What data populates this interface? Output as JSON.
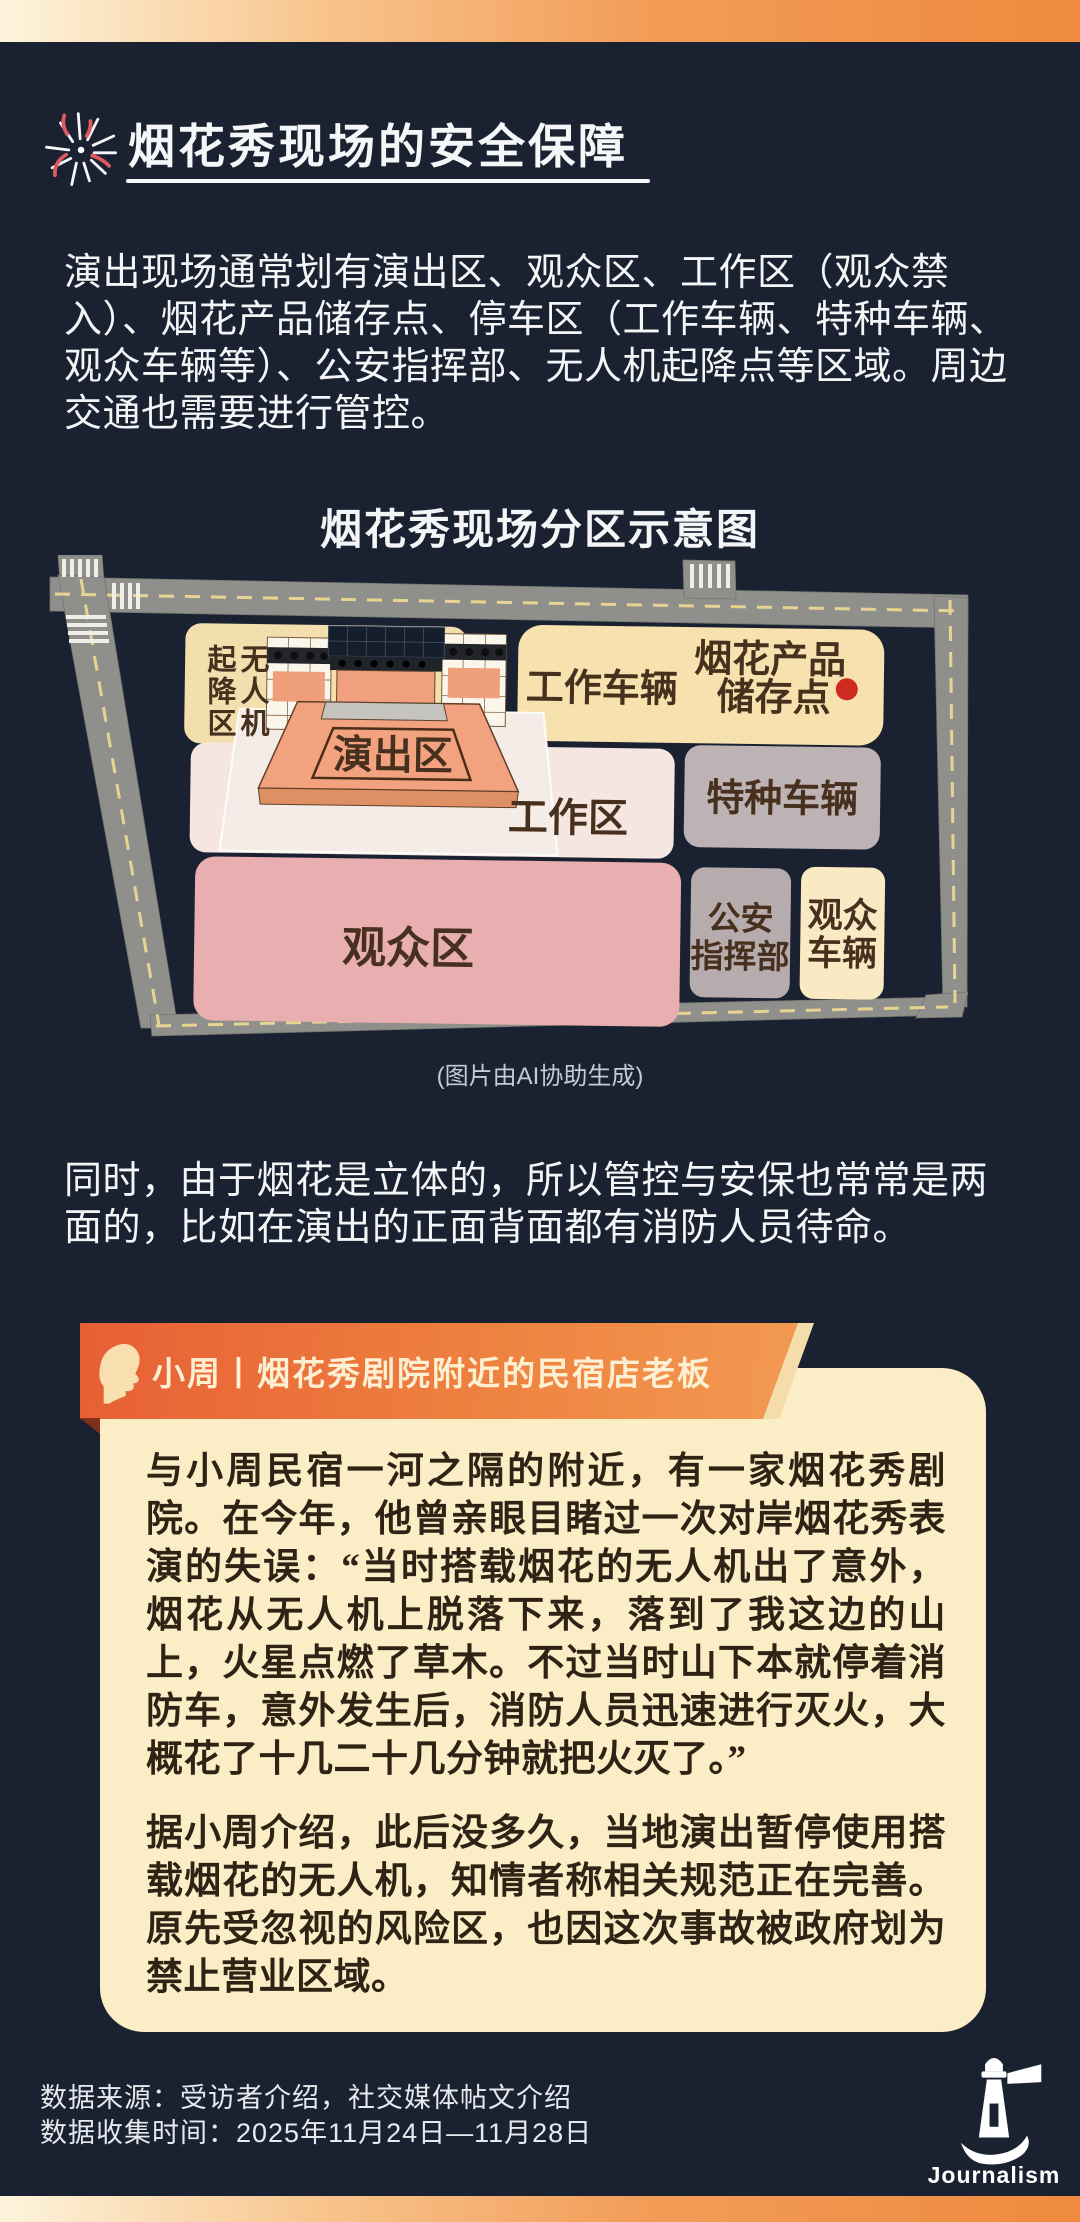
{
  "header": {
    "title": "烟花秀现场的安全保障"
  },
  "intro": "演出现场通常划有演出区、观众区、工作区（观众禁入）、烟花产品储存点、停车区（工作车辆、特种车辆、观众车辆等）、公安指挥部、无人机起降点等区域。周边交通也需要进行管控。",
  "diagram": {
    "title": "烟花秀现场分区示意图",
    "caption": "(图片由AI协助生成)",
    "zones": {
      "drone": "无人机起降区",
      "stage": "演出区",
      "work_vehicles": "工作车辆",
      "storage_l1": "烟花产品",
      "storage_l2": "储存点",
      "work_area": "工作区",
      "special_vehicles": "特种车辆",
      "audience_area": "观众区",
      "police_l1": "公安",
      "police_l2": "指挥部",
      "audience_vehicles_l1": "观众",
      "audience_vehicles_l2": "车辆"
    }
  },
  "body_paragraph": "同时，由于烟花是立体的，所以管控与安保也常常是两面的，比如在演出的正面背面都有消防人员待命。",
  "quote_card": {
    "header": "小周丨烟花秀剧院附近的民宿店老板",
    "paragraph1": "与小周民宿一河之隔的附近，有一家烟花秀剧院。在今年，他曾亲眼目睹过一次对岸烟花秀表演的失误：“当时搭载烟花的无人机出了意外，烟花从无人机上脱落下来，落到了我这边的山上，火星点燃了草木。不过当时山下本就停着消防车，意外发生后，消防人员迅速进行灭火，大概花了十几二十几分钟就把火灭了。”",
    "paragraph2": "据小周介绍，此后没多久，当地演出暂停使用搭载烟花的无人机，知情者称相关规范正在完善。原先受忽视的风险区，也因这次事故被政府划为禁止营业区域。"
  },
  "footer": {
    "source": "数据来源：受访者介绍，社交媒体帖文介绍",
    "period": "数据收集时间：2025年11月24日—11月28日",
    "logo_text": "Journalism"
  },
  "colors": {
    "background": "#1A2231",
    "accent_orange": "#EF8A3E",
    "card_cream": "#FBEDC6",
    "red_dot": "#CE2A1F"
  }
}
